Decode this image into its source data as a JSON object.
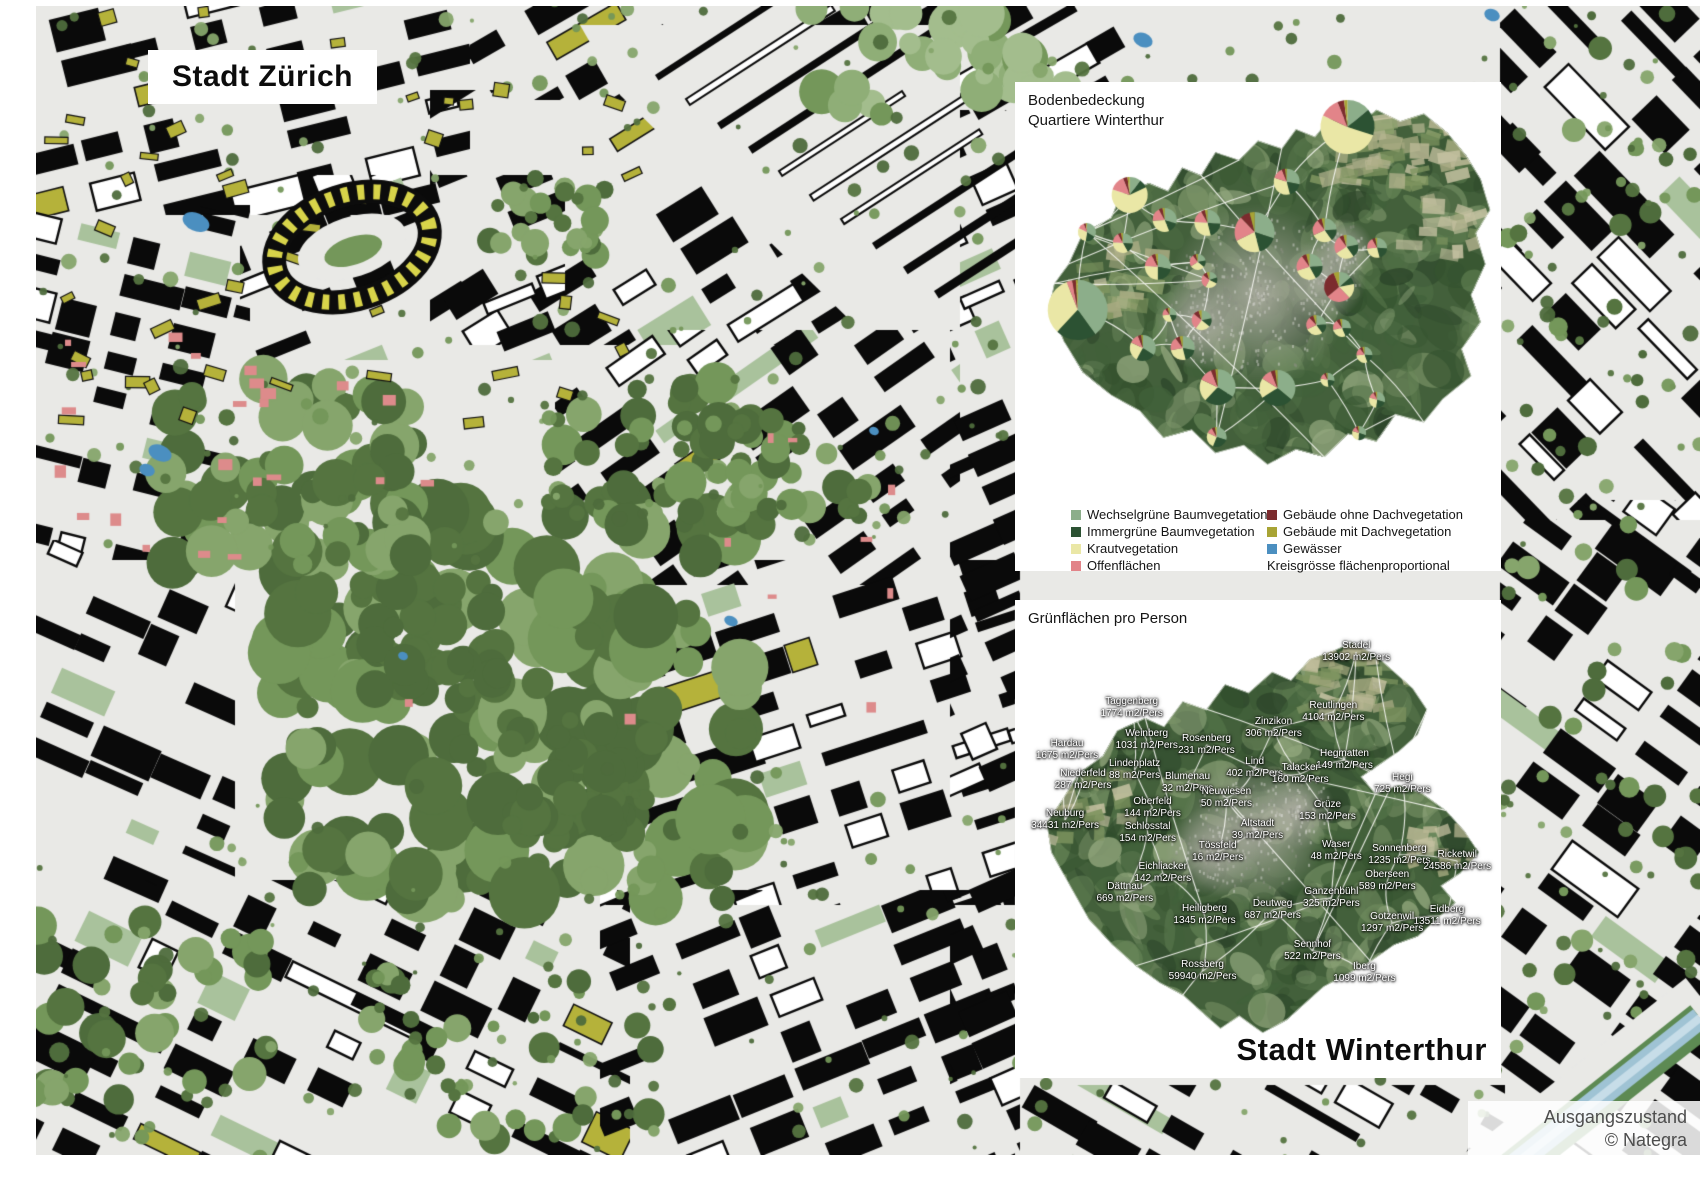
{
  "zurich": {
    "label": "Stadt Zürich"
  },
  "watermark": "Nategra",
  "attribution": {
    "line1": "Ausgangszustand",
    "line2": "© Nategra"
  },
  "panel_bodenbedeckung": {
    "title_line1": "Bodenbedeckung",
    "title_line2": "Quartiere Winterthur",
    "legend_left": [
      {
        "label": "Wechselgrüne Baumvegetation",
        "color": "#8cae8a"
      },
      {
        "label": "Immergrüne Baumvegetation",
        "color": "#2c5233"
      },
      {
        "label": "Krautvegetation",
        "color": "#eae7a6"
      },
      {
        "label": "Offenflächen",
        "color": "#e28489"
      }
    ],
    "legend_right": [
      {
        "label": "Gebäude ohne Dachvegetation",
        "color": "#7c2b2e"
      },
      {
        "label": "Gebäude mit Dachvegetation",
        "color": "#a8a435"
      },
      {
        "label": "Gewässer",
        "color": "#4b8fc0"
      }
    ],
    "legend_note": "Kreisgrösse flächenproportional"
  },
  "panel_gruenflaechen": {
    "title": "Grünflächen pro Person",
    "city_label": "Stadt Winterthur"
  },
  "chart_data": [
    {
      "type": "pie",
      "title": "Bodenbedeckung Quartiere Winterthur",
      "note": "Kreisgrösse flächenproportional",
      "categories": [
        "Wechselgrüne Baumvegetation",
        "Immergrüne Baumvegetation",
        "Krautvegetation",
        "Offenflächen",
        "Gebäude ohne Dachvegetation",
        "Gebäude mit Dachvegetation"
      ],
      "colors": [
        "#8cae8a",
        "#2c5233",
        "#eae7a6",
        "#e28489",
        "#7c2b2e",
        "#a8a435"
      ],
      "pies": [
        {
          "x": 68.4,
          "y": 9.2,
          "r": 27,
          "values": [
            0.14,
            0.16,
            0.52,
            0.12,
            0.04,
            0.02
          ]
        },
        {
          "x": 23.6,
          "y": 23.1,
          "r": 18,
          "values": [
            0.1,
            0.08,
            0.62,
            0.14,
            0.04,
            0.02
          ]
        },
        {
          "x": 55.9,
          "y": 20.4,
          "r": 13,
          "values": [
            0.28,
            0.18,
            0.34,
            0.14,
            0.04,
            0.02
          ]
        },
        {
          "x": 30.8,
          "y": 28.2,
          "r": 12,
          "values": [
            0.3,
            0.14,
            0.3,
            0.18,
            0.05,
            0.03
          ]
        },
        {
          "x": 39.6,
          "y": 28.8,
          "r": 13,
          "values": [
            0.26,
            0.2,
            0.3,
            0.16,
            0.05,
            0.03
          ]
        },
        {
          "x": 49.3,
          "y": 30.7,
          "r": 20,
          "values": [
            0.3,
            0.16,
            0.22,
            0.2,
            0.08,
            0.04
          ]
        },
        {
          "x": 63.7,
          "y": 30.3,
          "r": 12,
          "values": [
            0.24,
            0.16,
            0.28,
            0.22,
            0.06,
            0.04
          ]
        },
        {
          "x": 14.8,
          "y": 30.7,
          "r": 9,
          "values": [
            0.34,
            0.18,
            0.3,
            0.12,
            0.04,
            0.02
          ]
        },
        {
          "x": 22.2,
          "y": 32.9,
          "r": 10,
          "values": [
            0.26,
            0.16,
            0.34,
            0.16,
            0.05,
            0.03
          ]
        },
        {
          "x": 68.2,
          "y": 33.7,
          "r": 12,
          "values": [
            0.22,
            0.18,
            0.26,
            0.24,
            0.06,
            0.04
          ]
        },
        {
          "x": 74.5,
          "y": 33.9,
          "r": 10,
          "values": [
            0.26,
            0.2,
            0.28,
            0.18,
            0.05,
            0.03
          ]
        },
        {
          "x": 29.4,
          "y": 37.8,
          "r": 13,
          "values": [
            0.28,
            0.22,
            0.26,
            0.16,
            0.05,
            0.03
          ]
        },
        {
          "x": 37.6,
          "y": 36.8,
          "r": 8,
          "values": [
            0.22,
            0.14,
            0.3,
            0.24,
            0.06,
            0.04
          ]
        },
        {
          "x": 60.6,
          "y": 37.8,
          "r": 13,
          "values": [
            0.24,
            0.18,
            0.28,
            0.2,
            0.06,
            0.04
          ]
        },
        {
          "x": 40.0,
          "y": 40.5,
          "r": 8,
          "values": [
            0.2,
            0.12,
            0.26,
            0.28,
            0.09,
            0.05
          ]
        },
        {
          "x": 66.7,
          "y": 41.9,
          "r": 15,
          "values": [
            0.14,
            0.08,
            0.16,
            0.26,
            0.3,
            0.06
          ]
        },
        {
          "x": 12.9,
          "y": 46.6,
          "r": 30,
          "values": [
            0.4,
            0.22,
            0.32,
            0.03,
            0.02,
            0.01
          ]
        },
        {
          "x": 31.8,
          "y": 47.6,
          "r": 7,
          "values": [
            0.26,
            0.18,
            0.3,
            0.16,
            0.06,
            0.04
          ]
        },
        {
          "x": 38.4,
          "y": 48.7,
          "r": 10,
          "values": [
            0.22,
            0.14,
            0.24,
            0.26,
            0.09,
            0.05
          ]
        },
        {
          "x": 62.0,
          "y": 49.7,
          "r": 10,
          "values": [
            0.24,
            0.16,
            0.28,
            0.2,
            0.07,
            0.05
          ]
        },
        {
          "x": 67.3,
          "y": 50.3,
          "r": 9,
          "values": [
            0.26,
            0.18,
            0.28,
            0.18,
            0.06,
            0.04
          ]
        },
        {
          "x": 26.3,
          "y": 54.4,
          "r": 13,
          "values": [
            0.34,
            0.24,
            0.24,
            0.12,
            0.04,
            0.02
          ]
        },
        {
          "x": 34.5,
          "y": 54.4,
          "r": 12,
          "values": [
            0.28,
            0.18,
            0.26,
            0.18,
            0.06,
            0.04
          ]
        },
        {
          "x": 41.7,
          "y": 62.4,
          "r": 18,
          "values": [
            0.34,
            0.28,
            0.2,
            0.12,
            0.04,
            0.02
          ]
        },
        {
          "x": 54.0,
          "y": 62.6,
          "r": 18,
          "values": [
            0.36,
            0.3,
            0.18,
            0.1,
            0.04,
            0.02
          ]
        },
        {
          "x": 64.3,
          "y": 60.9,
          "r": 7,
          "values": [
            0.28,
            0.2,
            0.3,
            0.14,
            0.05,
            0.03
          ]
        },
        {
          "x": 71.9,
          "y": 55.8,
          "r": 8,
          "values": [
            0.26,
            0.18,
            0.3,
            0.16,
            0.06,
            0.04
          ]
        },
        {
          "x": 74.5,
          "y": 65.0,
          "r": 8,
          "values": [
            0.3,
            0.22,
            0.28,
            0.12,
            0.05,
            0.03
          ]
        },
        {
          "x": 41.5,
          "y": 72.6,
          "r": 10,
          "values": [
            0.3,
            0.26,
            0.26,
            0.1,
            0.05,
            0.03
          ]
        },
        {
          "x": 70.8,
          "y": 71.8,
          "r": 7,
          "values": [
            0.3,
            0.22,
            0.28,
            0.12,
            0.05,
            0.03
          ]
        }
      ]
    },
    {
      "type": "table",
      "title": "Grünflächen pro Person",
      "columns": [
        "Quartier",
        "Grünfläche pro Person"
      ],
      "rows": [
        {
          "name": "Stadel",
          "value": "13902 m2/Pers",
          "x": 70.2,
          "y": 10.9
        },
        {
          "name": "Taggenberg",
          "value": "1774 m2/Pers",
          "x": 24.0,
          "y": 22.6
        },
        {
          "name": "Reutlingen",
          "value": "4104 m2/Pers",
          "x": 65.5,
          "y": 23.4
        },
        {
          "name": "Zinzikon",
          "value": "306 m2/Pers",
          "x": 53.2,
          "y": 26.8
        },
        {
          "name": "Weinberg",
          "value": "1031 m2/Pers",
          "x": 27.1,
          "y": 29.3
        },
        {
          "name": "Rosenberg",
          "value": "231 m2/Pers",
          "x": 39.4,
          "y": 30.3
        },
        {
          "name": "Hardau",
          "value": "1675 m2/Pers",
          "x": 10.7,
          "y": 31.4
        },
        {
          "name": "Hegmatten",
          "value": "149 m2/Pers",
          "x": 67.8,
          "y": 33.5
        },
        {
          "name": "Lind",
          "value": "402 m2/Pers",
          "x": 49.3,
          "y": 35.1
        },
        {
          "name": "Lindenplatz",
          "value": "88 m2/Pers",
          "x": 24.6,
          "y": 35.6
        },
        {
          "name": "Talacker",
          "value": "160 m2/Pers",
          "x": 58.7,
          "y": 36.4
        },
        {
          "name": "Niederfeld",
          "value": "287 m2/Pers",
          "x": 14.0,
          "y": 37.7
        },
        {
          "name": "Blumenau",
          "value": "32 m2/Pers",
          "x": 35.5,
          "y": 38.3
        },
        {
          "name": "Hegi",
          "value": "725 m2/Pers",
          "x": 79.7,
          "y": 38.5
        },
        {
          "name": "Neuwiesen",
          "value": "50 m2/Pers",
          "x": 43.5,
          "y": 41.4
        },
        {
          "name": "Oberfeld",
          "value": "144 m2/Pers",
          "x": 28.3,
          "y": 43.5
        },
        {
          "name": "Grüze",
          "value": "153 m2/Pers",
          "x": 64.3,
          "y": 44.1
        },
        {
          "name": "Neuburg",
          "value": "34431 m2/Pers",
          "x": 10.3,
          "y": 46.0
        },
        {
          "name": "Altstadt",
          "value": "39 m2/Pers",
          "x": 49.9,
          "y": 48.1
        },
        {
          "name": "Schlosstal",
          "value": "154 m2/Pers",
          "x": 27.3,
          "y": 48.7
        },
        {
          "name": "Waser",
          "value": "48 m2/Pers",
          "x": 66.1,
          "y": 52.5
        },
        {
          "name": "Tössfeld",
          "value": "16 m2/Pers",
          "x": 41.7,
          "y": 52.7
        },
        {
          "name": "Sonnenberg",
          "value": "1235 m2/Pers",
          "x": 79.1,
          "y": 53.3
        },
        {
          "name": "Ricketwil",
          "value": "24586 m2/Pers",
          "x": 91.0,
          "y": 54.6
        },
        {
          "name": "Eichliacker",
          "value": "142 m2/Pers",
          "x": 30.4,
          "y": 57.1
        },
        {
          "name": "Oberseen",
          "value": "589 m2/Pers",
          "x": 76.6,
          "y": 58.8
        },
        {
          "name": "Dättnau",
          "value": "669 m2/Pers",
          "x": 22.6,
          "y": 61.3
        },
        {
          "name": "Ganzenbühl",
          "value": "325 m2/Pers",
          "x": 65.1,
          "y": 62.3
        },
        {
          "name": "Deutweg",
          "value": "687 m2/Pers",
          "x": 53.0,
          "y": 64.9
        },
        {
          "name": "Heiligberg",
          "value": "1345 m2/Pers",
          "x": 39.0,
          "y": 65.9
        },
        {
          "name": "Eidberg",
          "value": "13511 m2/Pers",
          "x": 88.9,
          "y": 66.1
        },
        {
          "name": "Gotzenwil",
          "value": "1297 m2/Pers",
          "x": 77.6,
          "y": 67.6
        },
        {
          "name": "Sennhof",
          "value": "522 m2/Pers",
          "x": 61.2,
          "y": 73.4
        },
        {
          "name": "Rossberg",
          "value": "59940 m2/Pers",
          "x": 38.6,
          "y": 77.6
        },
        {
          "name": "Iberg",
          "value": "1099 m2/Pers",
          "x": 71.9,
          "y": 78.0
        }
      ]
    }
  ]
}
